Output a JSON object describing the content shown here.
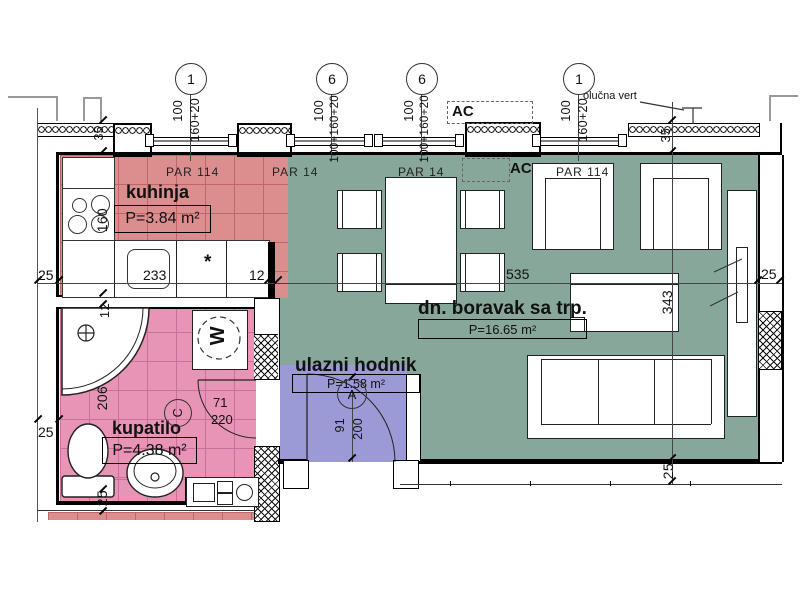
{
  "plan": {
    "rooms": {
      "kitchen": {
        "name": "kuhinja",
        "area": "P=3.84 m²",
        "floor": "PAR  114"
      },
      "living": {
        "name": "dn. boravak sa trp.",
        "area": "P=16.65 m²",
        "floor_left": "PAR  14",
        "floor_mid": "PAR  14",
        "floor_right": "PAR  114"
      },
      "bathroom": {
        "name": "kupatilo",
        "area": "P=4.38 m²"
      },
      "hall": {
        "name": "ulazni hodnik",
        "area": "P=1.58 m²"
      }
    },
    "grid_markers": [
      {
        "label": "1"
      },
      {
        "label": "6"
      },
      {
        "label": "6"
      },
      {
        "label": "1"
      }
    ],
    "window_dims": [
      {
        "sill": "100",
        "win": "160+20"
      },
      {
        "sill": "100",
        "win": "100+160+20"
      },
      {
        "sill": "100",
        "win": "100+160+20"
      },
      {
        "sill": "100",
        "win": "160+20"
      }
    ],
    "notes": {
      "gutter": "olučna vert",
      "ac_outdoor": "AC",
      "ac_indoor": "AC",
      "door_mark": "A",
      "fixture_mark": "C",
      "star": "*",
      "washer": "W"
    },
    "dims": {
      "wall_35_left": "35",
      "wall_35_right": "35",
      "wall_25_left_top": "25",
      "kitchen_width": "233",
      "kitchen_stub": "12",
      "living_width": "535",
      "wall_25_right": "25",
      "kitchen_depth": "160",
      "bath_wall_top": "12",
      "bath_depth": "206",
      "wall_25_left_mid": "25",
      "wall_25_bath_bottom": "25",
      "living_depth": "343",
      "wall_25_living_bottom": "25",
      "door_width": "91",
      "hall_width": "200",
      "bath_door_width": "71",
      "bath_door_height": "220"
    },
    "colors": {
      "kitchen": "#dc8e8e",
      "bathroom": "#e794b7",
      "living": "#87a79a",
      "hall": "#9b9ad7"
    }
  }
}
